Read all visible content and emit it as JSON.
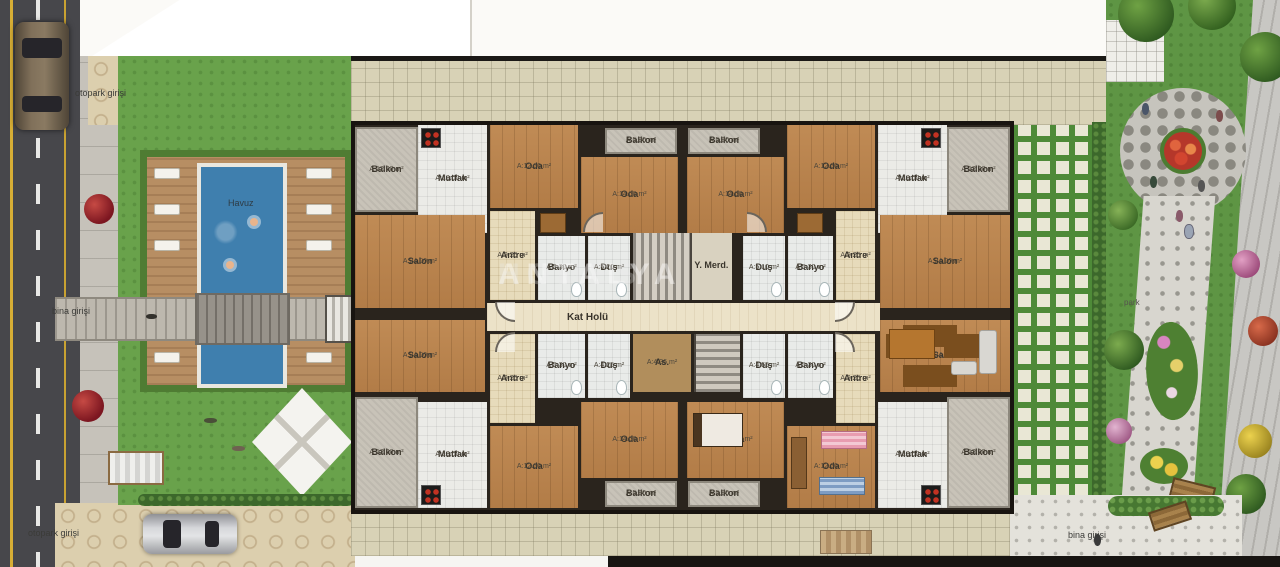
{
  "site": {
    "labels": {
      "parking_entrance_top": "otopark girişi",
      "building_entrance_left": "bina girişi",
      "parking_entrance_bottom": "otopark girişi",
      "pool": "Havuz",
      "park": "park",
      "building_entrance_right": "bina girişi"
    }
  },
  "watermark": {
    "brand_1": "ANTALYA",
    "brand_2": "HOMES"
  },
  "floor_plan": {
    "core": {
      "stairs_label": "Y. Merd.",
      "hall_label": "Kat Holü",
      "elevator_label": "As.",
      "elevator_area": "A:4.36 m²"
    },
    "rooms": [
      {
        "label": "Balkon",
        "area": "A:12.00 m²",
        "x": 0,
        "y": 2,
        "w": 63,
        "h": 85,
        "floor": "balcony"
      },
      {
        "label": "Mutfak",
        "area": "A:13.00 m²",
        "x": 63,
        "y": 0,
        "w": 69,
        "h": 108,
        "floor": "tile"
      },
      {
        "label": "Oda",
        "area": "A:12.00 m²",
        "x": 135,
        "y": 0,
        "w": 88,
        "h": 83,
        "floor": "wood"
      },
      {
        "label": "Balkon",
        "area": "A:5.80 m²",
        "x": 250,
        "y": 3,
        "w": 72,
        "h": 26,
        "floor": "balcony"
      },
      {
        "label": "Oda",
        "area": "A:14.00 m²",
        "x": 226,
        "y": 32,
        "w": 97,
        "h": 76,
        "floor": "wood"
      },
      {
        "label": "Salon",
        "area": "A:24.00 m²",
        "x": 0,
        "y": 90,
        "w": 130,
        "h": 93,
        "floor": "wood"
      },
      {
        "label": "Antre",
        "area": "A:9.25 m²",
        "x": 135,
        "y": 86,
        "w": 45,
        "h": 89,
        "floor": "hall"
      },
      {
        "label": "Banyo",
        "area": "A:5.30 m²",
        "x": 183,
        "y": 111,
        "w": 47,
        "h": 64,
        "floor": "bath"
      },
      {
        "label": "Duş",
        "area": "A:5.20 m²",
        "x": 233,
        "y": 111,
        "w": 42,
        "h": 64,
        "floor": "bath"
      },
      {
        "label": "Balkon",
        "area": "A:12.00 m²",
        "x": 592,
        "y": 2,
        "w": 63,
        "h": 85,
        "floor": "balcony"
      },
      {
        "label": "Mutfak",
        "area": "A:13.00 m²",
        "x": 523,
        "y": 0,
        "w": 69,
        "h": 108,
        "floor": "tile"
      },
      {
        "label": "Oda",
        "area": "A:12.00 m²",
        "x": 432,
        "y": 0,
        "w": 88,
        "h": 83,
        "floor": "wood"
      },
      {
        "label": "Balkon",
        "area": "A:5.80 m²",
        "x": 333,
        "y": 3,
        "w": 72,
        "h": 26,
        "floor": "balcony"
      },
      {
        "label": "Oda",
        "area": "A:14.00 m²",
        "x": 332,
        "y": 32,
        "w": 97,
        "h": 76,
        "floor": "wood"
      },
      {
        "label": "Salon",
        "area": "A:24.00 m²",
        "x": 525,
        "y": 90,
        "w": 130,
        "h": 93,
        "floor": "wood"
      },
      {
        "label": "Antre",
        "area": "A:9.25 m²",
        "x": 481,
        "y": 86,
        "w": 39,
        "h": 89,
        "floor": "hall"
      },
      {
        "label": "Banyo",
        "area": "A:5.30 m²",
        "x": 433,
        "y": 111,
        "w": 45,
        "h": 64,
        "floor": "bath"
      },
      {
        "label": "Duş",
        "area": "A:5.10 m²",
        "x": 388,
        "y": 111,
        "w": 42,
        "h": 64,
        "floor": "bath"
      },
      {
        "label": "Salon",
        "area": "A:24.00 m²",
        "x": 0,
        "y": 195,
        "w": 130,
        "h": 72,
        "floor": "wood"
      },
      {
        "label": "Antre",
        "area": "A:9.25 m²",
        "x": 135,
        "y": 209,
        "w": 45,
        "h": 89,
        "floor": "hall"
      },
      {
        "label": "Banyo",
        "area": "A:5.30 m²",
        "x": 183,
        "y": 209,
        "w": 47,
        "h": 64,
        "floor": "bath"
      },
      {
        "label": "Duş",
        "area": "A:4.25 m²",
        "x": 233,
        "y": 209,
        "w": 42,
        "h": 64,
        "floor": "bath"
      },
      {
        "label": "Balkon",
        "area": "A:12.00 m²",
        "x": 0,
        "y": 272,
        "w": 63,
        "h": 111,
        "floor": "balcony"
      },
      {
        "label": "Mutfak",
        "area": "A:13.00 m²",
        "x": 63,
        "y": 277,
        "w": 69,
        "h": 106,
        "floor": "tile"
      },
      {
        "label": "Oda",
        "area": "A:12.00 m²",
        "x": 135,
        "y": 301,
        "w": 88,
        "h": 82,
        "floor": "wood"
      },
      {
        "label": "Oda",
        "area": "A:14.00 m²",
        "x": 226,
        "y": 277,
        "w": 97,
        "h": 76,
        "floor": "wood"
      },
      {
        "label": "Balkon",
        "area": "A:5.80 m²",
        "x": 250,
        "y": 356,
        "w": 72,
        "h": 26,
        "floor": "balcony"
      },
      {
        "label": "Salon",
        "area": "A:24.00 m²",
        "x": 525,
        "y": 195,
        "w": 130,
        "h": 72,
        "floor": "wood"
      },
      {
        "label": "Antre",
        "area": "A:9.25 m²",
        "x": 481,
        "y": 209,
        "w": 39,
        "h": 89,
        "floor": "hall"
      },
      {
        "label": "Banyo",
        "area": "A:5.30 m²",
        "x": 433,
        "y": 209,
        "w": 45,
        "h": 64,
        "floor": "bath"
      },
      {
        "label": "Duş",
        "area": "A:4.55 m²",
        "x": 388,
        "y": 209,
        "w": 42,
        "h": 64,
        "floor": "bath"
      },
      {
        "label": "Balkon",
        "area": "A:12.00 m²",
        "x": 592,
        "y": 272,
        "w": 63,
        "h": 111,
        "floor": "balcony"
      },
      {
        "label": "Mutfak",
        "area": "A:13.00 m²",
        "x": 523,
        "y": 277,
        "w": 69,
        "h": 106,
        "floor": "tile"
      },
      {
        "label": "Oda",
        "area": "A:12.00 m²",
        "x": 432,
        "y": 301,
        "w": 88,
        "h": 82,
        "floor": "wood"
      },
      {
        "label": "Oda",
        "area": "A:14.00 m²",
        "x": 332,
        "y": 277,
        "w": 97,
        "h": 76,
        "floor": "wood"
      },
      {
        "label": "Balkon",
        "area": "A:5.80 m²",
        "x": 333,
        "y": 356,
        "w": 72,
        "h": 26,
        "floor": "balcony"
      }
    ]
  }
}
